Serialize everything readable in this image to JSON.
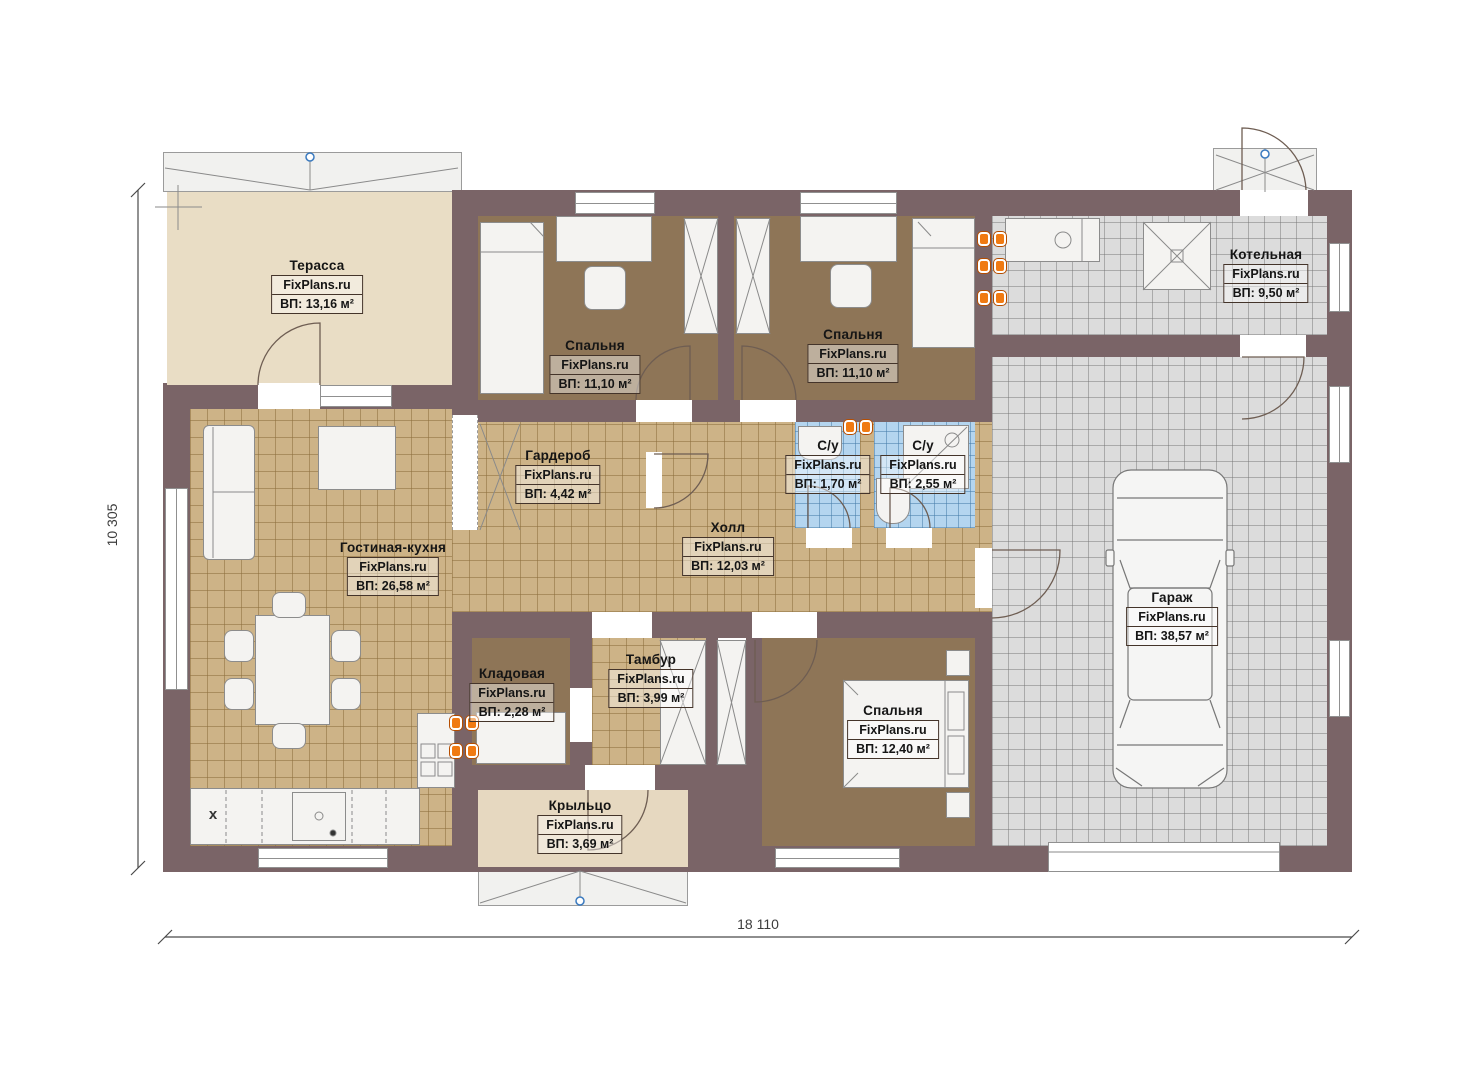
{
  "brand": "FixPlans.ru",
  "rooms": [
    {
      "key": "terrace",
      "name": "Терасса",
      "brand": "FixPlans.ru",
      "area": "ВП: 13,16 м²"
    },
    {
      "key": "bedroom-1",
      "name": "Спальня",
      "brand": "FixPlans.ru",
      "area": "ВП: 11,10 м²"
    },
    {
      "key": "bedroom-2",
      "name": "Спальня",
      "brand": "FixPlans.ru",
      "area": "ВП: 11,10 м²"
    },
    {
      "key": "boiler-room",
      "name": "Котельная",
      "brand": "FixPlans.ru",
      "area": "ВП: 9,50 м²"
    },
    {
      "key": "wardrobe",
      "name": "Гардероб",
      "brand": "FixPlans.ru",
      "area": "ВП: 4,42 м²"
    },
    {
      "key": "bathroom-1",
      "name": "С/у",
      "brand": "FixPlans.ru",
      "area": "ВП: 1,70 м²"
    },
    {
      "key": "bathroom-2",
      "name": "С/у",
      "brand": "FixPlans.ru",
      "area": "ВП: 2,55 м²"
    },
    {
      "key": "hall",
      "name": "Холл",
      "brand": "FixPlans.ru",
      "area": "ВП: 12,03 м²"
    },
    {
      "key": "living-kitchen",
      "name": "Гостиная-кухня",
      "brand": "FixPlans.ru",
      "area": "ВП: 26,58 м²"
    },
    {
      "key": "garage",
      "name": "Гараж",
      "brand": "FixPlans.ru",
      "area": "ВП: 38,57 м²"
    },
    {
      "key": "storage",
      "name": "Кладовая",
      "brand": "FixPlans.ru",
      "area": "ВП: 2,28 м²"
    },
    {
      "key": "vestibule",
      "name": "Тамбур",
      "brand": "FixPlans.ru",
      "area": "ВП: 3,99 м²"
    },
    {
      "key": "bedroom-3",
      "name": "Спальня",
      "brand": "FixPlans.ru",
      "area": "ВП: 12,40 м²"
    },
    {
      "key": "porch",
      "name": "Крыльцо",
      "brand": "FixPlans.ru",
      "area": "ВП: 3,69 м²"
    }
  ],
  "dimensions": {
    "bottom": "18 110",
    "left": "10 305"
  },
  "annotations": {
    "kitchen_x": "x"
  },
  "colors": {
    "wall": "#7a6467",
    "tile_tan": "#cdb387",
    "bedroom_floor": "#8e7557",
    "bath_tile": "#b4d5ef",
    "garage_tile": "#dcdcdc",
    "terrace_floor": "#e9ddc5",
    "equipment_orange": "#f07a12",
    "control_point_blue": "#3a7abf"
  }
}
